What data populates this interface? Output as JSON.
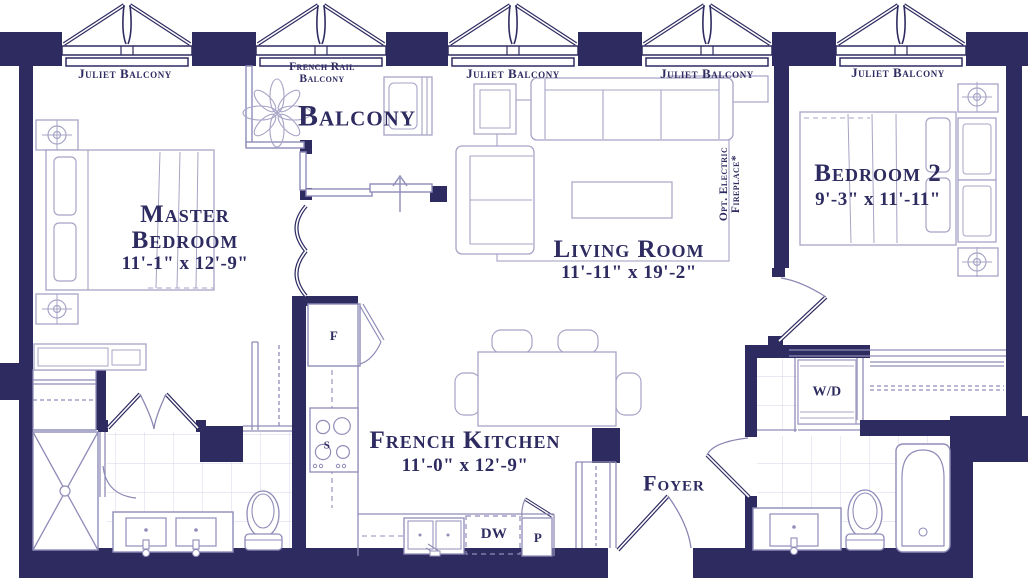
{
  "colors": {
    "wall": "#2e2b61",
    "arch_line": "#8f8cb8",
    "furniture_line": "#a7a4c6",
    "tile_line": "#dedcec",
    "text": "#2e2b61",
    "background": "#ffffff"
  },
  "balconies": {
    "juliet": [
      "Juliet Balcony",
      "Juliet Balcony",
      "Juliet Balcony",
      "Juliet Balcony"
    ],
    "french_rail_line1": "French Rail",
    "french_rail_line2": "Balcony",
    "balcony": "Balcony"
  },
  "rooms": {
    "master_bedroom": {
      "line1": "Master",
      "line2": "Bedroom",
      "dims": "11'-1\" x 12'-9\""
    },
    "living_room": {
      "name": "Living Room",
      "dims": "11'-11\" x 19'-2\""
    },
    "bedroom_2": {
      "name": "Bedroom 2",
      "dims": "9'-3\" x 11'-11\""
    },
    "kitchen": {
      "name": "French Kitchen",
      "dims": "11'-0\" x 12'-9\""
    },
    "foyer": {
      "name": "Foyer"
    }
  },
  "appliances": {
    "fridge": "F",
    "stove": "S",
    "dishwasher": "DW",
    "pantry": "P",
    "washer_dryer": "W/D"
  },
  "notes": {
    "fireplace_line1": "Opt. Electric",
    "fireplace_line2": "Fireplace*"
  }
}
